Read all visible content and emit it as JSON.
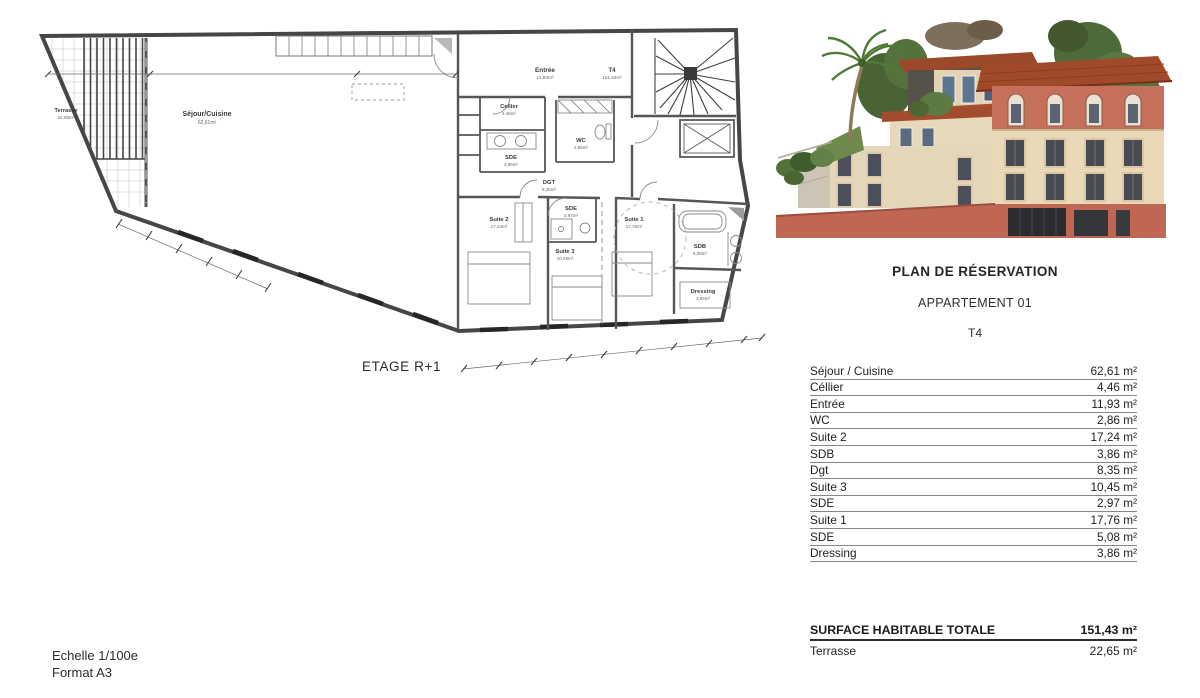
{
  "panel": {
    "title": "PLAN DE RÉSERVATION",
    "subtitle": "APPARTEMENT 01",
    "type_label": "T4",
    "table": {
      "rows": [
        {
          "label": "Séjour / Cuisine",
          "value": "62,61 m²"
        },
        {
          "label": "Céllier",
          "value": "4,46 m²"
        },
        {
          "label": "Entrée",
          "value": "11,93 m²"
        },
        {
          "label": "WC",
          "value": "2,86 m²"
        },
        {
          "label": "Suite 2",
          "value": "17,24 m²"
        },
        {
          "label": "SDB",
          "value": "3,86 m²"
        },
        {
          "label": "Dgt",
          "value": "8,35 m²"
        },
        {
          "label": "Suite 3",
          "value": "10,45 m²"
        },
        {
          "label": "SDE",
          "value": "2,97 m²"
        },
        {
          "label": "Suite 1",
          "value": "17,76 m²"
        },
        {
          "label": "SDE",
          "value": "5,08 m²"
        },
        {
          "label": "Dressing",
          "value": "3,86 m²"
        }
      ]
    },
    "totals": {
      "label": "SURFACE HABITABLE TOTALE",
      "value": "151,43 m²",
      "terrace_label": "Terrasse",
      "terrace_value": "22,65 m²"
    }
  },
  "plan": {
    "caption": "ETAGE R+1",
    "scale_note": "Echelle 1/100e",
    "format_note": "Format A3",
    "rooms": [
      {
        "name": "Terrasse",
        "area": "22,65m²"
      },
      {
        "name": "Séjour/Cuisine",
        "area": "62,61m²"
      },
      {
        "name": "Entrée",
        "area": "11,93m²"
      },
      {
        "name": "T4",
        "area": "151,43m²"
      },
      {
        "name": "Cellier",
        "area": "4,46m²"
      },
      {
        "name": "WC",
        "area": "2,86m²"
      },
      {
        "name": "SDE",
        "area": "3,86m²"
      },
      {
        "name": "DGT",
        "area": "8,35m²"
      },
      {
        "name": "Suite 2",
        "area": "17,24m²"
      },
      {
        "name": "SDE",
        "area": "2,97m²"
      },
      {
        "name": "Suite 3",
        "area": "10,45m²"
      },
      {
        "name": "Suite 1",
        "area": "17,76m²"
      },
      {
        "name": "SDB",
        "area": "5,08m²"
      },
      {
        "name": "Dressing",
        "area": "3,86m²"
      }
    ]
  },
  "colors": {
    "facade_cream": "#e8dabc",
    "roof_terracotta": "#a04a2a",
    "band_salmon": "#c5705a",
    "base_salmon": "#bf6752",
    "window_dark": "#474a50",
    "foliage_green": "#4e6a38",
    "plan_line": "#3f3f3f"
  }
}
